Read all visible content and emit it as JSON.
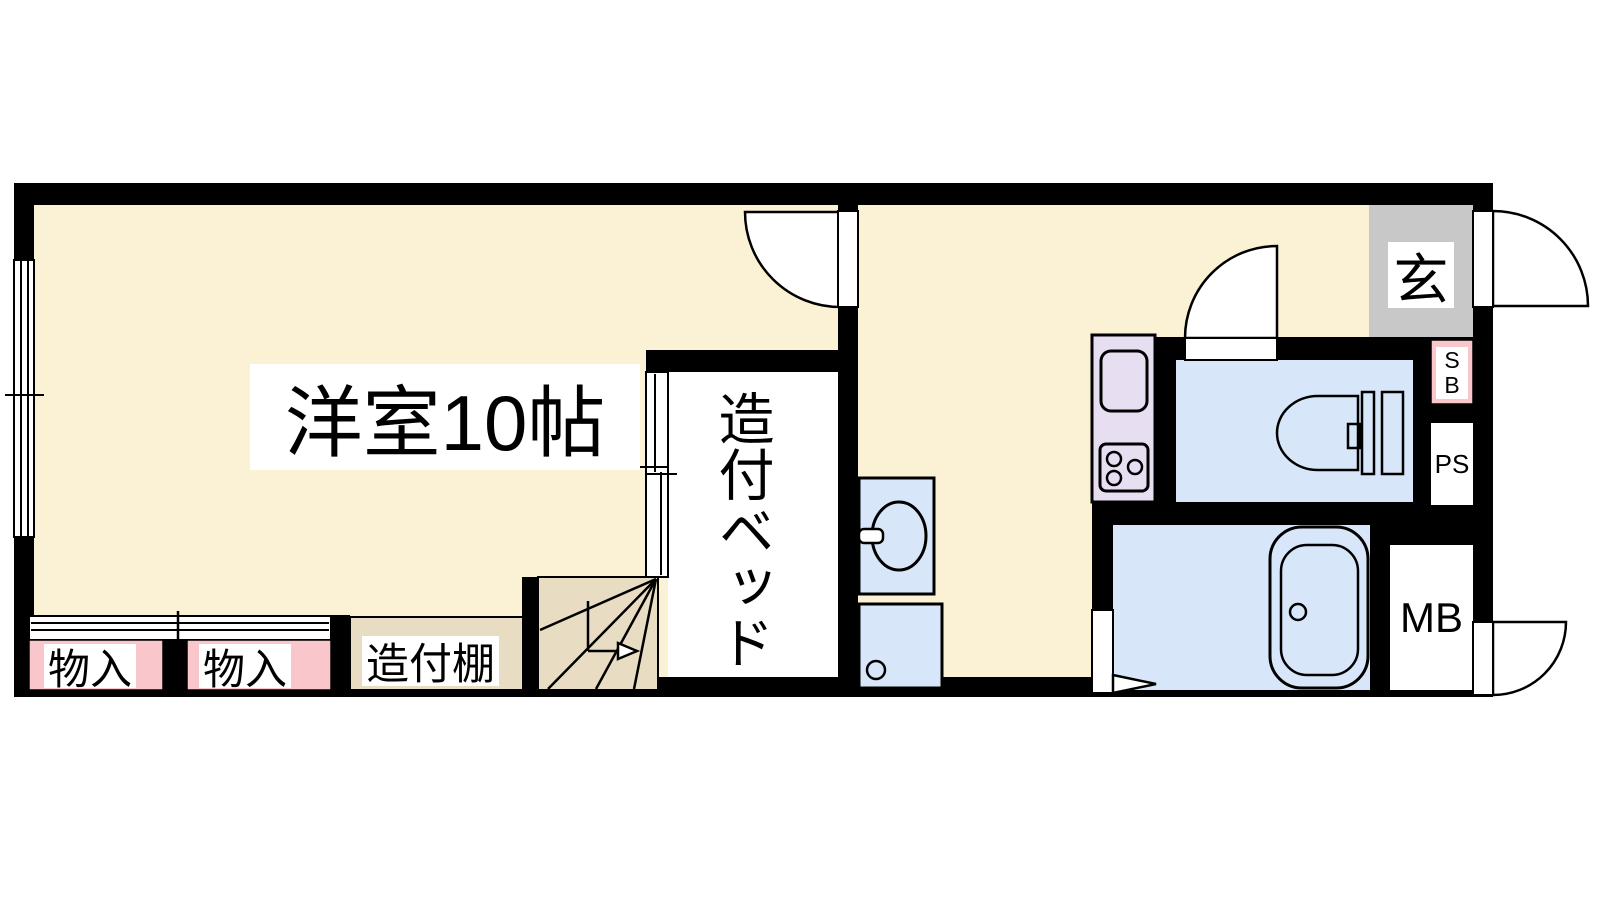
{
  "title": "apartment-floor-plan",
  "colors": {
    "floor_cream": "#FBF2D6",
    "stairs_shelf_tan": "#E8DCC2",
    "closet_pink": "#F9C6CB",
    "wet_area_blue": "#D7E7F9",
    "kitchen_lavender": "#E8DEF2",
    "entrance_gray": "#C8C8C8",
    "wall_black": "#000000"
  },
  "rooms": {
    "main_room": {
      "label": "洋室10帖"
    },
    "built_in_bed": {
      "label": "造付ベッド"
    },
    "storage_1": {
      "label": "物入"
    },
    "storage_2": {
      "label": "物入"
    },
    "built_in_shelf": {
      "label": "造付棚"
    },
    "entrance": {
      "label": "玄"
    },
    "shaft_sb": {
      "label": "S\nB"
    },
    "pipe_space": {
      "label": "PS"
    },
    "meter_box": {
      "label": "MB"
    }
  }
}
